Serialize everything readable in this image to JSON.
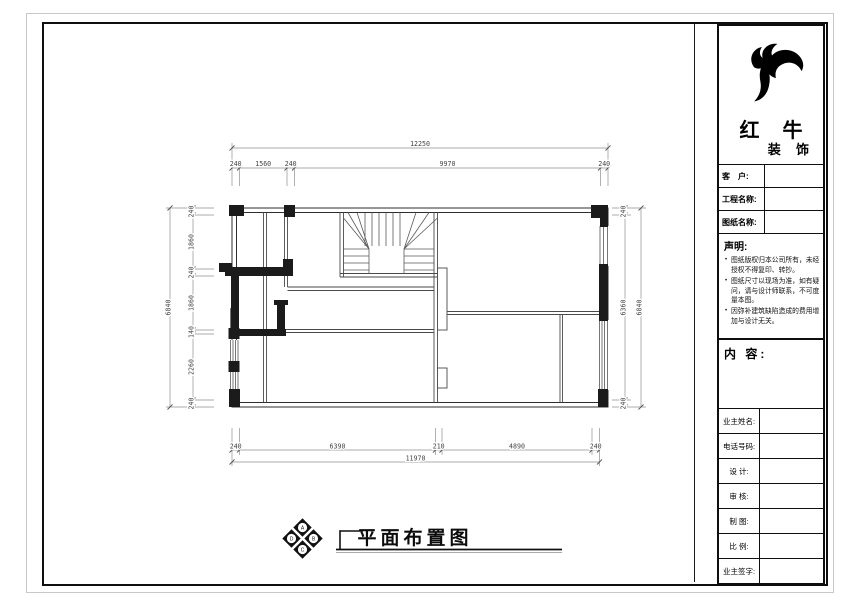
{
  "title_block": {
    "logo": {
      "name_main": "红 牛",
      "name_sub": "装 饰"
    },
    "fields": [
      {
        "label": "客　户:",
        "value": ""
      },
      {
        "label": "工程名称:",
        "value": ""
      },
      {
        "label": "图纸名称:",
        "value": ""
      }
    ],
    "statement": {
      "title": "声明:",
      "items": [
        "图纸版权归本公司所有，未经授权不得复印、转抄。",
        "图纸尺寸以现场为准，如有疑问，请与设计师联系，不可度量本图。",
        "因弥补建筑缺陷造成的费用增加与设计无关。"
      ]
    },
    "content_label": "内 容:",
    "table_rows": [
      {
        "label": "业主姓名:",
        "value": ""
      },
      {
        "label": "电话号码:",
        "value": ""
      },
      {
        "label": "设 计:",
        "value": ""
      },
      {
        "label": "审 核:",
        "value": ""
      },
      {
        "label": "制 图:",
        "value": ""
      },
      {
        "label": "比 例:",
        "value": ""
      },
      {
        "label": "业主签字:",
        "value": ""
      }
    ]
  },
  "drawing": {
    "title": "平面布置图",
    "compass_letters": [
      "A",
      "B",
      "C",
      "D"
    ],
    "dims": {
      "top": {
        "total": "12250",
        "segments": [
          "240",
          "1560",
          "240",
          "9970",
          "240"
        ]
      },
      "bottom": {
        "total": "11970",
        "segments": [
          "240",
          "6390",
          "210",
          "4890",
          "240"
        ]
      },
      "left": {
        "total": "6840",
        "segments": [
          "240",
          "1860",
          "240",
          "1860",
          "140",
          "2260",
          "240"
        ]
      },
      "right": {
        "total": "6840",
        "segments": [
          "240",
          "6360",
          "240"
        ]
      }
    },
    "colors": {
      "wall": "#2e2e2e",
      "dim_line": "#8f8f8f",
      "dim_text": "#444444"
    }
  }
}
